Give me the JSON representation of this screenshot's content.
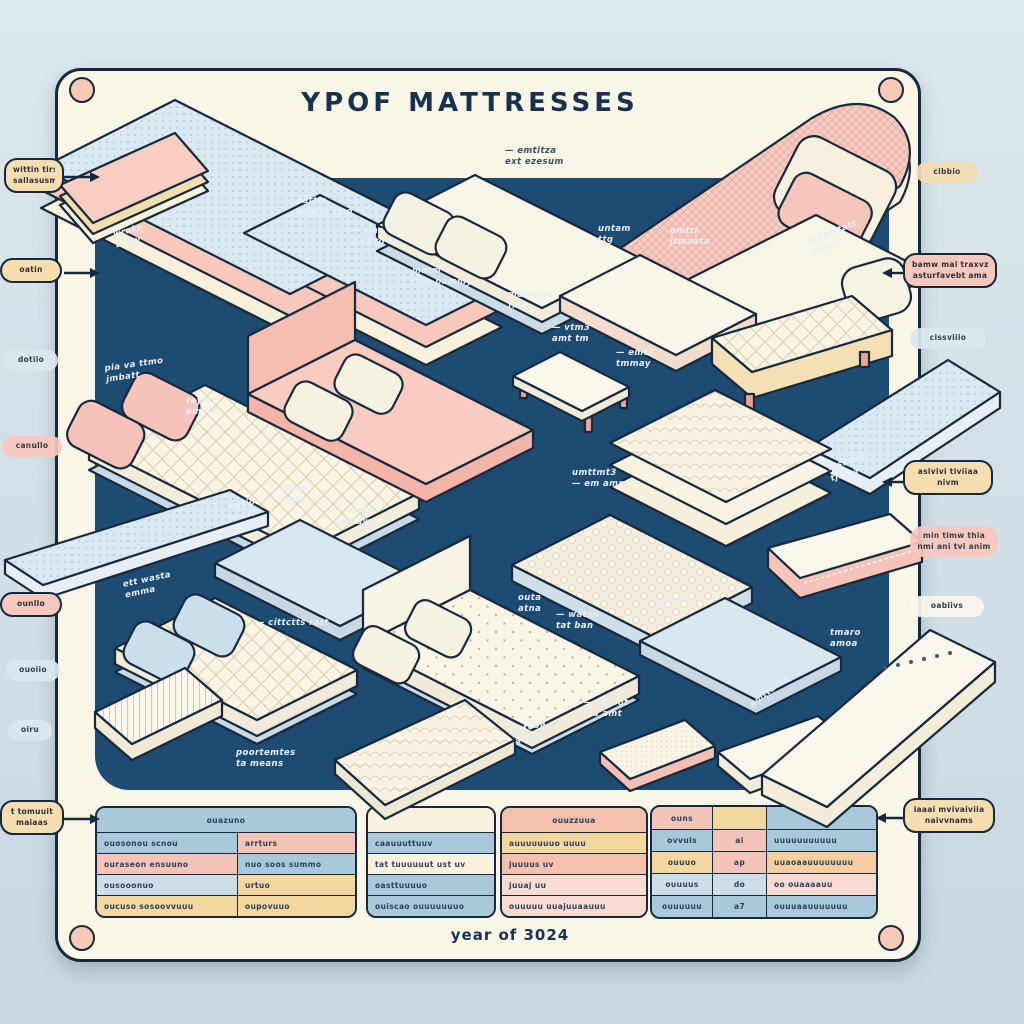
{
  "title": "YPOF MATTRESSES",
  "caption": "year of 3024",
  "colors": {
    "page_bg": "#d3e0e7",
    "board_bg": "#f9f5e7",
    "panel_bg": "#1e4b72",
    "outline": "#15283c",
    "accent_pink": "#f5c4b8",
    "accent_blue": "#a9c8da",
    "accent_yellow": "#f3d79e",
    "accent_tan": "#f6ddb0",
    "screw": "#f6c9b4"
  },
  "callouts": {
    "left": [
      {
        "l1": "wittin tirs",
        "l2": "sallasusm"
      },
      {
        "l1": "oatin",
        "l2": ""
      },
      {
        "l1": "dotiio",
        "l2": ""
      },
      {
        "l1": "canullo",
        "l2": ""
      },
      {
        "l1": "ounllo",
        "l2": ""
      },
      {
        "l1": "ouoiio",
        "l2": ""
      },
      {
        "l1": "oiru",
        "l2": ""
      },
      {
        "l1": "t tomuuit",
        "l2": "maiaas"
      }
    ],
    "right": [
      {
        "l1": "cibbio",
        "l2": ""
      },
      {
        "l1": "bamw mai traxvz",
        "l2": "asturfavebt ama"
      },
      {
        "l1": "cissviiio",
        "l2": ""
      },
      {
        "l1": "asivivi tiviiaa",
        "l2": "nivm"
      },
      {
        "l1": "min timw thia",
        "l2": "nmi ani tvi anim"
      },
      {
        "l1": "oabiivs",
        "l2": ""
      },
      {
        "l1": "iaaai mvivaiviia",
        "l2": "naivvnams"
      }
    ]
  },
  "panel_labels": [
    {
      "l1": "wrako",
      "l2": "amty"
    },
    {
      "l1": "uattm",
      "l2": "aaatta tmo"
    },
    {
      "l1": "— tiaz",
      "l2": "gaaitd lo"
    },
    {
      "l1": "— emtitza",
      "l2": "ext ezesum"
    },
    {
      "l1": "untam",
      "l2": "ttg"
    },
    {
      "l1": "emtrr",
      "l2": "jtmaata"
    },
    {
      "l1": "atbaaitatt",
      "l2": "cxwrv"
    },
    {
      "l1": "pia va ttmo",
      "l2": "jmbatt"
    },
    {
      "l1": "teyttv",
      "l2": "amvio"
    },
    {
      "l1": "matm",
      "l2": "tma pammy"
    },
    {
      "l1": "matmum",
      "l2": "fmo"
    },
    {
      "l1": "— vtm3",
      "l2": "amt tm"
    },
    {
      "l1": "— emt3",
      "l2": "tmmay"
    },
    {
      "l1": "wgtio",
      "l2": "amos"
    },
    {
      "l1": "vntso",
      "l2": "amta"
    },
    {
      "l1": "— mats",
      "l2": "tan awry"
    },
    {
      "l1": "umttmt3",
      "l2": "— em amn"
    },
    {
      "l1": "vtssims",
      "l2": "tjama"
    },
    {
      "l1": "ett wasta",
      "l2": "emma"
    },
    {
      "l1": "— cittctts ratt",
      "l2": ""
    },
    {
      "l1": "poortemtes",
      "l2": "ta means"
    },
    {
      "l1": "outa",
      "l2": "atna"
    },
    {
      "l1": "— watsn",
      "l2": "tat ban"
    },
    {
      "l1": "pamxty",
      "l2": ""
    },
    {
      "l1": "— setsot",
      "l2": "(ta amt"
    },
    {
      "l1": "attooa",
      "l2": "ataas"
    },
    {
      "l1": "amttucta",
      "l2": ""
    },
    {
      "l1": "tmaro",
      "l2": "amoa"
    }
  ],
  "tables": {
    "t1": {
      "header": "ouazuno",
      "rows": [
        [
          "ouosonou scnou",
          "arrturs"
        ],
        [
          "ouraseon ensuuno",
          "nuo soos summo"
        ],
        [
          "ousooonuo",
          "urtuo"
        ],
        [
          "oucuso sosoovvuuu",
          "oupovuuo"
        ]
      ]
    },
    "t2": {
      "rows": [
        "caauuuttuuv",
        "tat tuuuuuut ust uv",
        "oasttuuuuo",
        "ouiscao ouuuuuuuo"
      ]
    },
    "t3": {
      "header": "ouuzzuua",
      "rows": [
        "auuuuuuuo uuuu",
        "juuuus uv",
        "juuaj uu",
        "ouuuuu uuajuuaauuu"
      ]
    },
    "t4": {
      "header": [
        "ouns",
        "",
        ""
      ],
      "rows": [
        [
          "ovvuis",
          "ai",
          "uuuuuuuuuuu"
        ],
        [
          "ouuuo",
          "ap",
          "uuaoaauuuuuuuu"
        ],
        [
          "ouuuus",
          "do",
          "oo ouaaaauu"
        ],
        [
          "ouuuuuu",
          "a7",
          "ouuuaauuuuuuu"
        ]
      ]
    }
  }
}
